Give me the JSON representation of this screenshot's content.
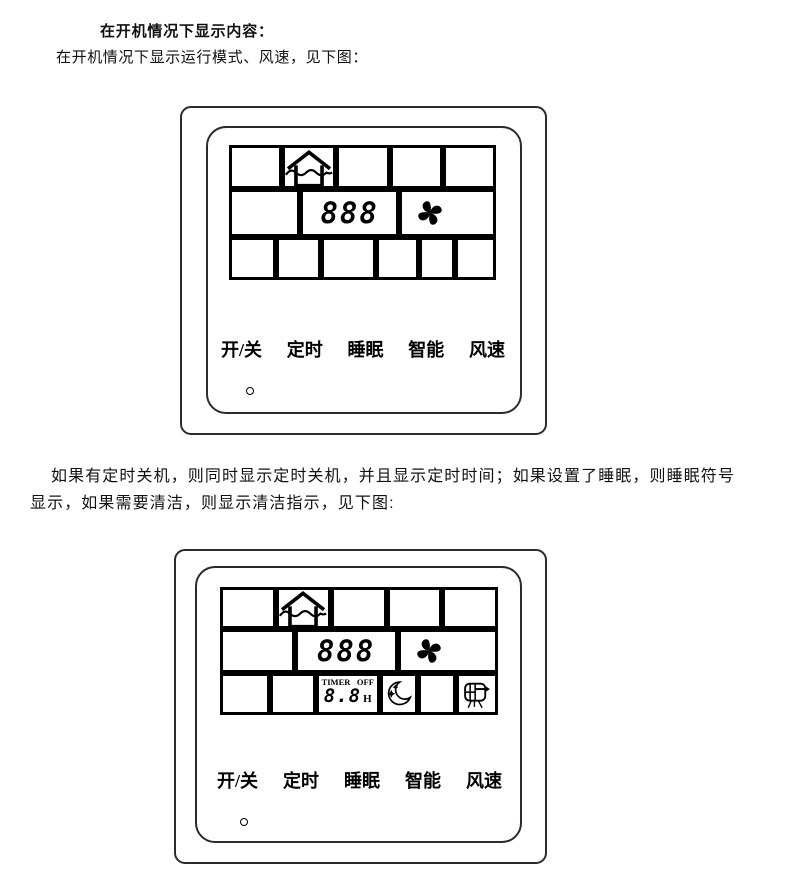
{
  "document": {
    "heading": "在开机情况下显示内容：",
    "intro": "在开机情况下显示运行模式、风速，见下图：",
    "para2_line1": "如果有定时关机，则同时显示定时关机，并且显示定时时间；如果设置了睡眠，则睡眠符号",
    "para2_line2": "显示，如果需要清洁，则显示清洁指示，见下图:"
  },
  "colors": {
    "ink": "#000000",
    "paper": "#ffffff"
  },
  "panel_on": {
    "lcd": {
      "mode_icon": "house-auto-mode-icon",
      "temperature": "888",
      "fan_icon": "fan-speed-icon"
    },
    "buttons": [
      "开/关",
      "定时",
      "睡眠",
      "智能",
      "风速"
    ]
  },
  "panel_timer": {
    "lcd": {
      "mode_icon": "house-auto-mode-icon",
      "temperature": "888",
      "fan_icon": "fan-speed-icon",
      "timer_label": "TIMER",
      "timer_state": "OFF",
      "timer_hours": "8.8",
      "timer_unit": "H",
      "sleep_icon": "moon-sleep-icon",
      "clean_icon": "filter-clean-icon"
    },
    "buttons": [
      "开/关",
      "定时",
      "睡眠",
      "智能",
      "风速"
    ]
  }
}
